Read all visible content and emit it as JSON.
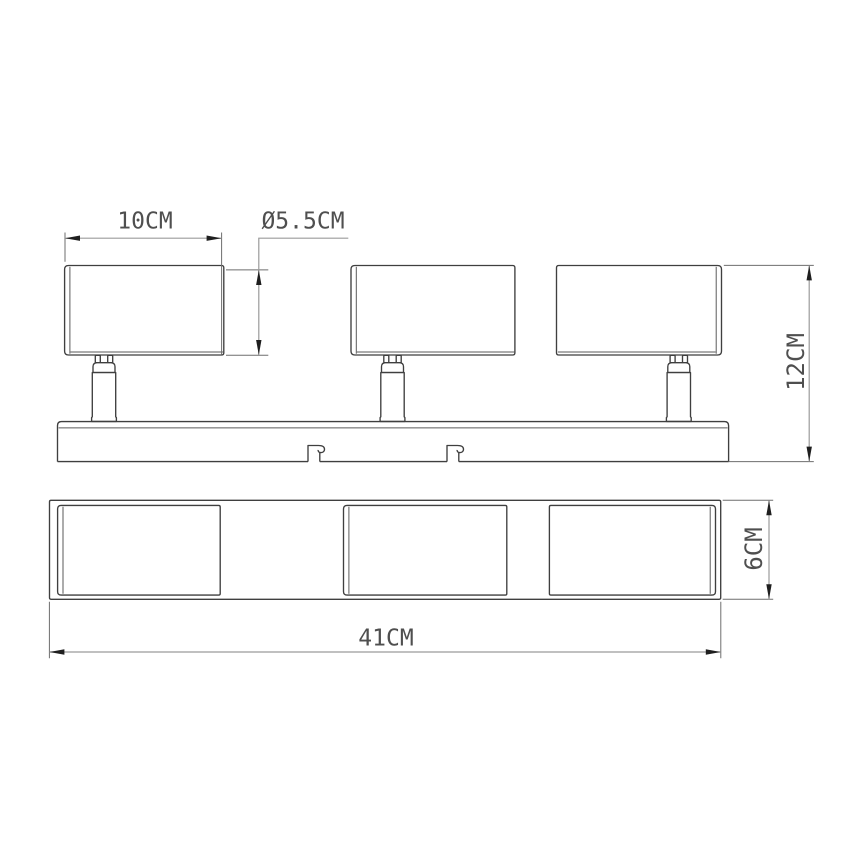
{
  "dimensions": {
    "head_width": "10CM",
    "head_diameter": "Ø5.5CM",
    "fixture_height": "12CM",
    "base_height": "6CM",
    "total_width": "41CM"
  },
  "colors": {
    "background": "#ffffff",
    "object_line": "#3f3f3f",
    "detail_line": "#5a5a5a",
    "extension_line": "#6e6e6e",
    "dimension_line": "#9b9b9b",
    "arrow": "#1f1f1f",
    "text": "#4f4f4f"
  }
}
